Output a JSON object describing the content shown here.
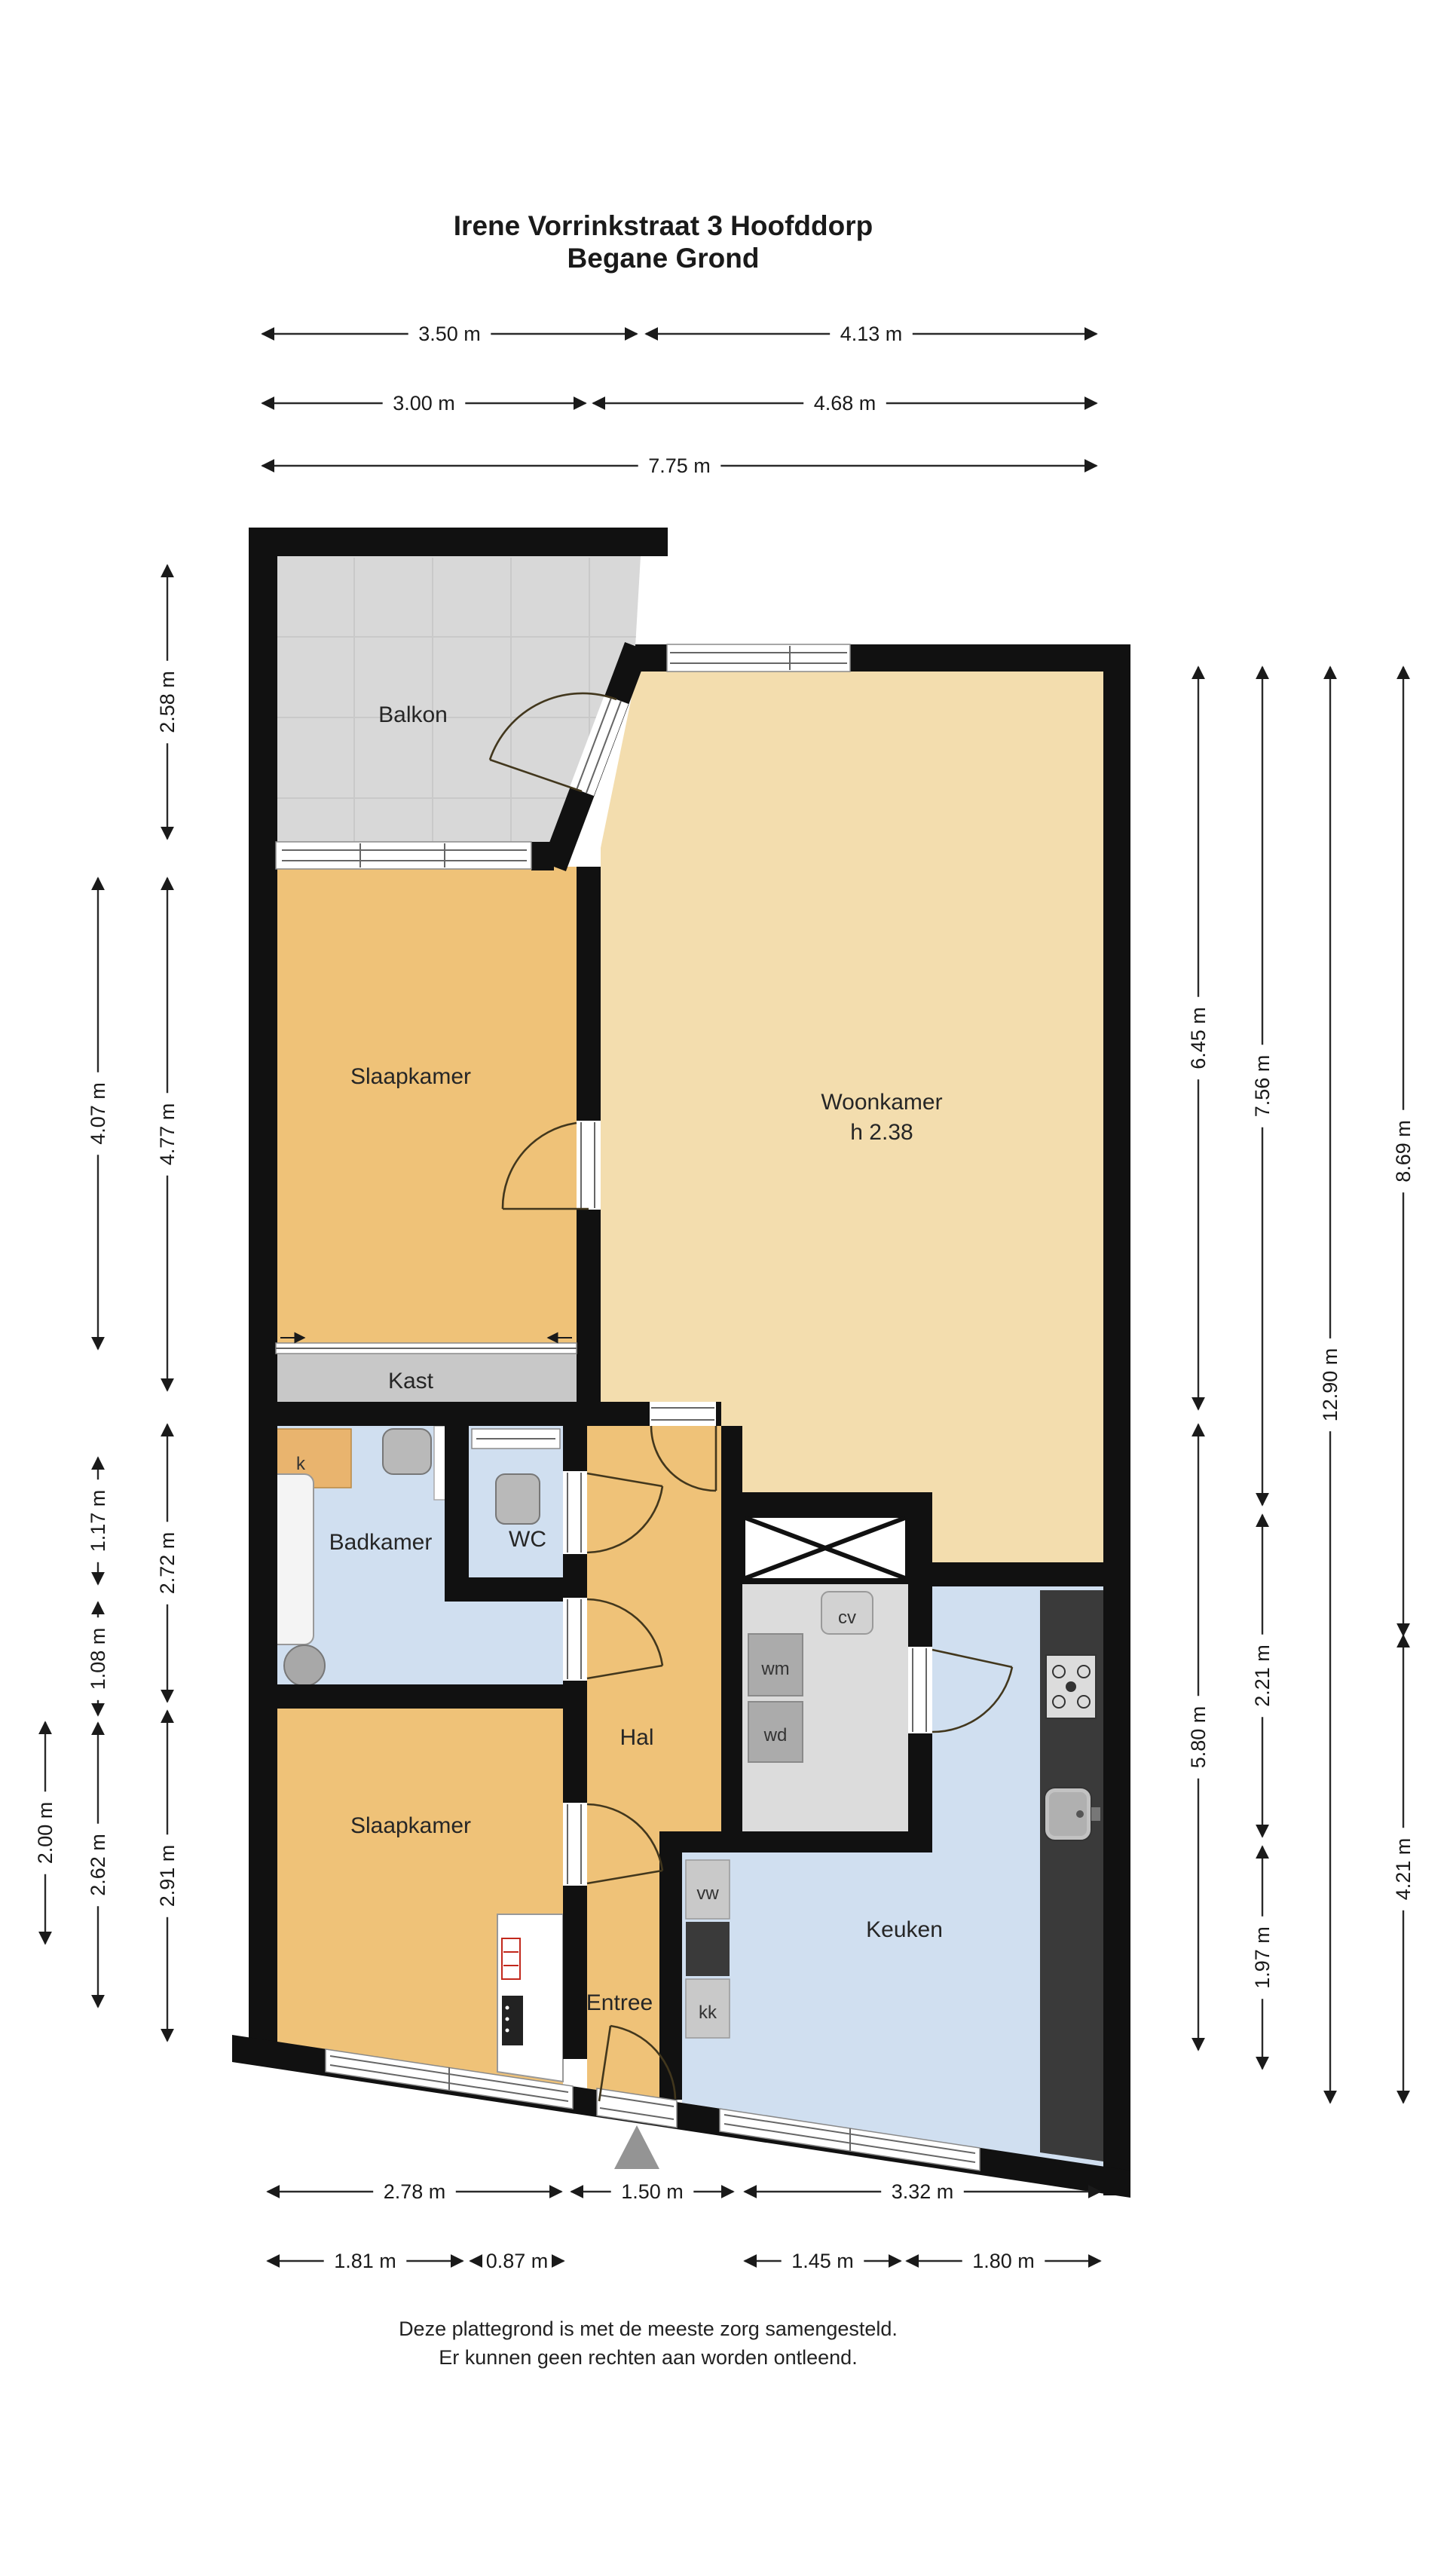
{
  "title": {
    "line1": "Irene Vorrinkstraat 3 Hoofddorp",
    "line2": "Begane Grond"
  },
  "footer": {
    "line1": "Deze plattegrond is met de meeste zorg samengesteld.",
    "line2": "Er kunnen geen rechten aan worden ontleend."
  },
  "rooms": {
    "balkon": "Balkon",
    "slaapkamer_boven": "Slaapkamer",
    "woonkamer": "Woonkamer",
    "woonkamer_hoogte": "h 2.38",
    "kast": "Kast",
    "badkamer": "Badkamer",
    "wc": "WC",
    "hal": "Hal",
    "slaapkamer_onder": "Slaapkamer",
    "entree": "Entree",
    "keuken": "Keuken"
  },
  "fixtures": {
    "kast_klein": "k",
    "cv_ketel": "cv",
    "wasmachine": "wm",
    "wasdroger": "wd",
    "vaatwasser": "vw",
    "koelkast": "kk"
  },
  "colors": {
    "wall": "#111111",
    "room_orange": "#efc278",
    "room_tan": "#f3ddae",
    "room_blue": "#d0dff0",
    "balkon_gray": "#d8d8d8",
    "kast_gray": "#c8c8c8",
    "tech_gray": "#dcdcdc",
    "counter_dark": "#3a3a3a",
    "entrance_triangle": "#949494",
    "radiator_red": "#c2281c"
  },
  "dimensions": {
    "top": [
      {
        "label": "3.50 m",
        "axis": "h",
        "c": 443,
        "a": 348,
        "b": 845
      },
      {
        "label": "4.13 m",
        "axis": "h",
        "c": 443,
        "a": 857,
        "b": 1455
      },
      {
        "label": "3.00 m",
        "axis": "h",
        "c": 535,
        "a": 348,
        "b": 777
      },
      {
        "label": "4.68 m",
        "axis": "h",
        "c": 535,
        "a": 787,
        "b": 1455
      },
      {
        "label": "7.75 m",
        "axis": "h",
        "c": 618,
        "a": 348,
        "b": 1455
      }
    ],
    "left": [
      {
        "label": "2.58 m",
        "axis": "v",
        "c": 222,
        "a": 750,
        "b": 1113
      },
      {
        "label": "4.77 m",
        "axis": "v",
        "c": 222,
        "a": 1165,
        "b": 1845
      },
      {
        "label": "2.72 m",
        "axis": "v",
        "c": 222,
        "a": 1890,
        "b": 2258
      },
      {
        "label": "2.91 m",
        "axis": "v",
        "c": 222,
        "a": 2270,
        "b": 2708
      },
      {
        "label": "4.07 m",
        "axis": "v",
        "c": 130,
        "a": 1165,
        "b": 1790
      },
      {
        "label": "1.17 m",
        "axis": "v",
        "c": 130,
        "a": 1934,
        "b": 2102
      },
      {
        "label": "1.08 m",
        "axis": "v",
        "c": 130,
        "a": 2126,
        "b": 2276
      },
      {
        "label": "2.62 m",
        "axis": "v",
        "c": 130,
        "a": 2286,
        "b": 2663
      },
      {
        "label": "2.00 m",
        "axis": "v",
        "c": 60,
        "a": 2285,
        "b": 2579
      }
    ],
    "right": [
      {
        "label": "6.45 m",
        "axis": "v",
        "c": 1590,
        "a": 885,
        "b": 1870
      },
      {
        "label": "5.80 m",
        "axis": "v",
        "c": 1590,
        "a": 1890,
        "b": 2720
      },
      {
        "label": "7.56 m",
        "axis": "v",
        "c": 1675,
        "a": 885,
        "b": 1997
      },
      {
        "label": "2.21 m",
        "axis": "v",
        "c": 1675,
        "a": 2010,
        "b": 2437
      },
      {
        "label": "1.97 m",
        "axis": "v",
        "c": 1675,
        "a": 2450,
        "b": 2745
      },
      {
        "label": "12.90 m",
        "axis": "v",
        "c": 1765,
        "a": 885,
        "b": 2790
      },
      {
        "label": "8.69 m",
        "axis": "v",
        "c": 1862,
        "a": 885,
        "b": 2170
      },
      {
        "label": "4.21 m",
        "axis": "v",
        "c": 1862,
        "a": 2170,
        "b": 2790
      }
    ],
    "bottom": [
      {
        "label": "2.78 m",
        "axis": "h",
        "c": 2908,
        "a": 355,
        "b": 745
      },
      {
        "label": "1.50 m",
        "axis": "h",
        "c": 2908,
        "a": 758,
        "b": 973
      },
      {
        "label": "3.32 m",
        "axis": "h",
        "c": 2908,
        "a": 988,
        "b": 1460
      },
      {
        "label": "1.81 m",
        "axis": "h",
        "c": 3000,
        "a": 355,
        "b": 614
      },
      {
        "label": "0.87 m",
        "axis": "h",
        "c": 3000,
        "a": 624,
        "b": 748
      },
      {
        "label": "1.45 m",
        "axis": "h",
        "c": 3000,
        "a": 988,
        "b": 1195
      },
      {
        "label": "1.80 m",
        "axis": "h",
        "c": 3000,
        "a": 1203,
        "b": 1460
      }
    ]
  }
}
